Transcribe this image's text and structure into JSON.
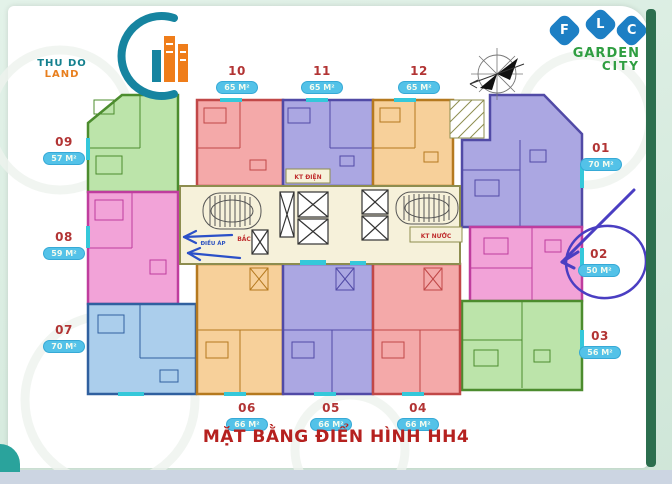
{
  "page": {
    "title": "MẶT BẰNG ĐIỂN HÌNH HH4"
  },
  "branding": {
    "thu_do_land": {
      "text_primary": "THU DO",
      "text_secondary": "LAND"
    },
    "flc": {
      "letters": [
        "F",
        "L",
        "C"
      ],
      "line1": "GARDEN",
      "line2": "CITY",
      "blue": "#1d7fc4",
      "green": "#2f9e41"
    }
  },
  "units": [
    {
      "number": "01",
      "area": "70 M²"
    },
    {
      "number": "02",
      "area": "50 M²"
    },
    {
      "number": "03",
      "area": "56 M²"
    },
    {
      "number": "04",
      "area": "66 M²"
    },
    {
      "number": "05",
      "area": "66 M²"
    },
    {
      "number": "06",
      "area": "66 M²"
    },
    {
      "number": "07",
      "area": "70 M²"
    },
    {
      "number": "08",
      "area": "59 M²"
    },
    {
      "number": "09",
      "area": "57 M²"
    },
    {
      "number": "10",
      "area": "65 M²"
    },
    {
      "number": "11",
      "area": "65 M²"
    },
    {
      "number": "12",
      "area": "65 M²"
    }
  ],
  "core": {
    "labels": {
      "kt_dien": "KT ĐIỆN",
      "kt_nuoc": "KT NƯỚC",
      "dieu_ap": "ĐIỀU ÁP",
      "bac": "BẮC"
    }
  },
  "annotations": {
    "circled_unit": "02",
    "ink_color": "#4a3ec2",
    "left_arrow_ink_color": "#2b50c8"
  },
  "icons": {
    "compass": "compass-rose",
    "logo_icon": "building-swoosh",
    "elevator": "crossed-box",
    "stairs": "racetrack-stair"
  },
  "palette": {
    "salmon": {
      "fill": "#f4a9a9",
      "line": "#c14848"
    },
    "magenta": {
      "fill": "#f2a3d8",
      "line": "#bf3d9e"
    },
    "purple": {
      "fill": "#aba7e2",
      "line": "#514aa6"
    },
    "orange": {
      "fill": "#f7d09a",
      "line": "#b5791f"
    },
    "green": {
      "fill": "#bce4aa",
      "line": "#4c8c2e"
    },
    "blue": {
      "fill": "#abceec",
      "line": "#30609f"
    },
    "core": {
      "fill": "#f6f1da",
      "line": "#8d8d4f"
    },
    "accent_teal": "#35c8da",
    "badge_bg": "#53c2e8",
    "unit_number_red": "#b23434",
    "title_red": "#b5211f",
    "edge_green": "#2c6e4e"
  }
}
